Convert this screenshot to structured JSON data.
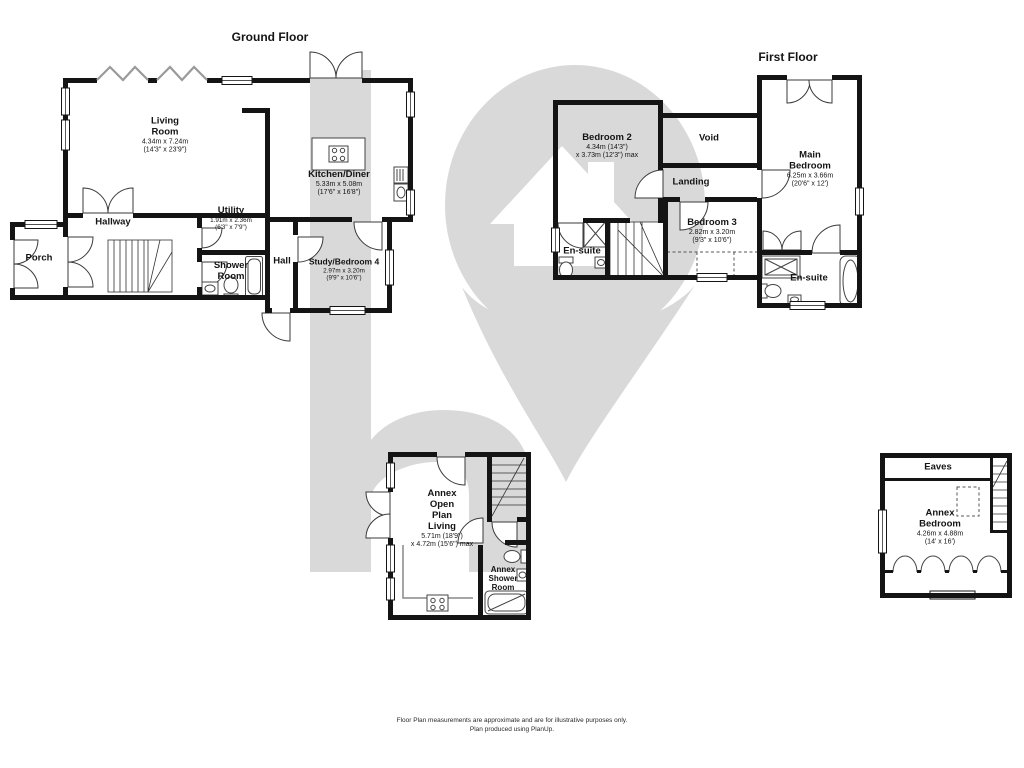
{
  "watermark": {
    "icon": "house-pin-logo",
    "letter": "h",
    "color": "#d9d9d9"
  },
  "ground_floor": {
    "title": "Ground Floor",
    "rooms": {
      "living_room": {
        "name": "Living\nRoom",
        "dims_m": "4.34m x 7.24m",
        "dims_ft": "(14'3\" x 23'9\")"
      },
      "kitchen_diner": {
        "name": "Kitchen/Diner",
        "dims_m": "5.33m x 5.08m",
        "dims_ft": "(17'6\" x 16'8\")"
      },
      "hallway": {
        "name": "Hallway"
      },
      "porch": {
        "name": "Porch"
      },
      "utility": {
        "name": "Utility",
        "dims_m": "1.91m x 2.36m",
        "dims_ft": "(6'3\" x 7'9\")"
      },
      "shower_room": {
        "name": "Shower\nRoom"
      },
      "hall": {
        "name": "Hall"
      },
      "study_bedroom_4": {
        "name": "Study/Bedroom 4",
        "dims_m": "2.97m x 3.20m",
        "dims_ft": "(9'9\" x 10'6\")"
      }
    }
  },
  "first_floor": {
    "title": "First Floor",
    "rooms": {
      "bedroom_2": {
        "name": "Bedroom 2",
        "dims_m": "4.34m (14'3\")",
        "dims_ft": "x 3.73m (12'3\") max"
      },
      "void": {
        "name": "Void"
      },
      "landing": {
        "name": "Landing"
      },
      "main_bedroom": {
        "name": "Main\nBedroom",
        "dims_m": "6.25m x 3.66m",
        "dims_ft": "(20'6\" x 12')"
      },
      "en_suite_left": {
        "name": "En-suite"
      },
      "bedroom_3": {
        "name": "Bedroom 3",
        "dims_m": "2.82m x 3.20m",
        "dims_ft": "(9'3\" x 10'6\")"
      },
      "en_suite_right": {
        "name": "En-suite"
      }
    }
  },
  "annex": {
    "rooms": {
      "open_plan_living": {
        "name": "Annex\nOpen\nPlan\nLiving",
        "dims_m": "5.71m (18'9\")",
        "dims_ft": "x 4.72m (15'6\") max"
      },
      "shower_room": {
        "name": "Annex\nShower\nRoom"
      }
    }
  },
  "annex_bedroom": {
    "rooms": {
      "eaves": {
        "name": "Eaves"
      },
      "bedroom": {
        "name": "Annex\nBedroom",
        "dims_m": "4.26m x 4.88m",
        "dims_ft": "(14' x 16')"
      }
    }
  },
  "footer": {
    "line1": "Floor Plan measurements are approximate and are for illustrative purposes only.",
    "line2": "Plan produced using PlanUp."
  }
}
